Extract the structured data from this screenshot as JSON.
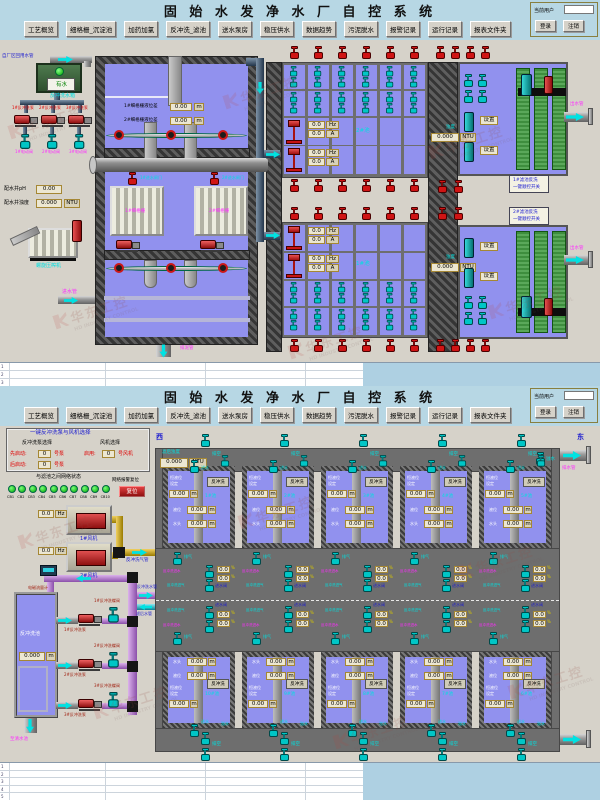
{
  "header": {
    "title": "固 始 水 发 净 水 厂 自 控 系 统",
    "menu": [
      "工艺概览",
      "细格栅_沉淀池",
      "加药加氯",
      "反冲洗_滤池",
      "送水泵房",
      "稳压供水",
      "数据趋势",
      "污泥脱水",
      "报警记录",
      "运行记录",
      "报表文件夹"
    ],
    "user_label": "当前用户",
    "login": "登录",
    "logout": "注销"
  },
  "watermark": {
    "text": "华东工控",
    "subtext": "HD INDUSTRY CONTROL"
  },
  "s1": {
    "inlet_pipe": "自厂区回用水管",
    "water_ok": "有水",
    "bw_tank": "反冲洗水箱",
    "bw_pumps": [
      "1#反冲洗泵",
      "2#反冲洗泵",
      "3#反冲洗泵"
    ],
    "e_valves": [
      "1#电动阀",
      "2#电动阀",
      "3#电动阀"
    ],
    "ph_label": "配水井pH",
    "ph_value": "0.00",
    "turb_label": "配水井浊度",
    "turb_value": "0.000",
    "ntu": "NTU",
    "screw": "螺旋压榨机",
    "inflow": "进水管",
    "lvl1": "1#细格栅液位差",
    "lvl2": "2#细格栅液位差",
    "lvl_value": "0.00",
    "m": "m",
    "gates": [
      "1#进水闸门",
      "2#进水闸门"
    ],
    "screens": [
      "1#细格栅",
      "2#细格栅"
    ],
    "sludge": "排泥管",
    "pool_top": "2#池",
    "pool_bottom": "1#池",
    "hz_value": "0.0",
    "hz": "Hz",
    "a_value": "0.0",
    "a": "A",
    "turb2_label": "浊度",
    "turb2_value": "0.000",
    "setting": "设置",
    "outflow": "出水管",
    "seq": [
      [
        "1#滤池反洗",
        "一键顺控开关"
      ],
      [
        "2#滤池反洗",
        "一键顺控开关"
      ]
    ]
  },
  "s2": {
    "panel": {
      "title": "一键反冲洗泵与风机选择",
      "pump_sel": "反冲洗泵选择",
      "fan_sel": "风机选择",
      "first": "先启动:",
      "later": "后启动:",
      "enable": "启用:",
      "no_pump": "号泵",
      "no_fan": "号风机",
      "num": "0",
      "net": "与滤池之间网络状态",
      "net_alarm": "网络报警复位",
      "reset": "复位",
      "cbs": [
        "CB1",
        "CB2",
        "CB3",
        "CB4",
        "CB5",
        "CB6",
        "CB7",
        "CB8",
        "CB9",
        "CB10"
      ]
    },
    "fans": [
      "1#风机",
      "2#风机"
    ],
    "hz_value": "0.0",
    "hz": "Hz",
    "air_pipe": "反冲洗气管",
    "water_pipe": "反冲洗水管",
    "filtered_pipe": "滤后水管",
    "flowmeter": "电磁流量计",
    "tank": "反冲洗池",
    "tank_level": "0.000",
    "m": "m",
    "pumps": [
      "1#反冲洗泵",
      "2#反冲洗泵",
      "3#反冲洗泵"
    ],
    "bvalves": [
      "1#反冲洗蝶阀",
      "2#反冲洗蝶阀",
      "3#反冲洗蝶阀"
    ],
    "to_clear": "至清水池",
    "west": "西",
    "east": "东",
    "turb_label": "滤后浊度",
    "turb_value": "0.000",
    "ntu": "NTU",
    "drain": "排水管",
    "empty": "排空",
    "overflow": "溢水",
    "inlet": "进水",
    "vent": "排气",
    "bw_in_water": "反冲洗进水",
    "bw_in_air": "反冲洗进气",
    "inlet_valve": "进水阀",
    "pct_value": "0.0",
    "pct": "%",
    "cell": {
      "const1": "恒液位",
      "const2": "设定",
      "level": "液位",
      "head": "水头",
      "value": "0.00",
      "backwash": "反冲洗"
    },
    "cells_top": [
      "1#池",
      "2#池",
      "3#池",
      "4#池",
      "5#池"
    ],
    "cells_bottom": [
      "10#池",
      "9#池",
      "8#池",
      "7#池",
      "6#池"
    ]
  }
}
